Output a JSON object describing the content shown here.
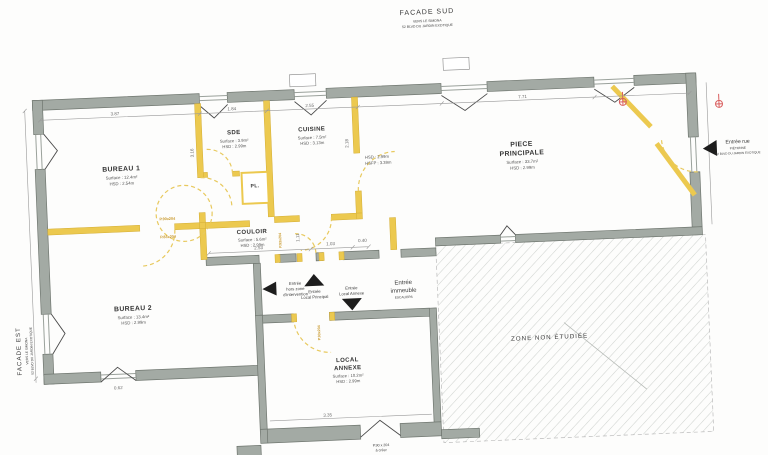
{
  "facade_sud": {
    "title": "FACADE SUD",
    "sub1": "VERS LE SIMONA",
    "sub2": "52 BLVD DU JARDIN EXOTIQUE"
  },
  "facade_est": {
    "title": "FACADE EST",
    "sub1": "VERS LE SIMONA",
    "sub2": "52 BLVD DU JARDIN EXOTIQUE"
  },
  "entree_rue": {
    "title": "Entrée rue",
    "sub1": "PIÉTONNE",
    "sub2": "52 BLVD DU JARDIN EXOTIQUE"
  },
  "rooms": [
    {
      "name": "BUREAU 1",
      "surface": "Surface : 12.4m²",
      "hsd": "HSD : 2.54m"
    },
    {
      "name": "SDE",
      "surface": "Surface : 3.9m²",
      "hsd": "HSD : 2.99m"
    },
    {
      "name": "CUISINE",
      "surface": "Surface : 7.5m²",
      "hsd": "HSD : 3.13m"
    },
    {
      "name1": "PIECE",
      "name2": "PRINCIPALE",
      "surface": "Surface : 33.7m²",
      "hsd": "HSD : 2.99m"
    },
    {
      "name": "COULOIR",
      "surface": "Surface : 5.6m²",
      "hsd": "HSD : 2.99m"
    },
    {
      "name": "BUREAU 2",
      "surface": "Surface : 13.4m²",
      "hsd": "HSD : 2.99m"
    },
    {
      "name1": "LOCAL",
      "name2": "ANNEXE",
      "surface": "Surface : 10.2m²",
      "hsd": "HSD : 2.99m"
    }
  ],
  "closet_label": "PL.",
  "height_note": {
    "l1": "HSD : 2.99m",
    "l2": "HSFP : 3.39m"
  },
  "zone_label": "ZONE NON ÉTUDIÉE",
  "entries": {
    "hors_zone": {
      "l1": "Entrée",
      "l2": "hors zone",
      "l3": "d'intervention"
    },
    "principal": {
      "l1": "Entrée",
      "l2": "Local Principal"
    },
    "annexe": {
      "l1": "Entrée",
      "l2": "Local Annexe"
    },
    "immeuble": {
      "l1": "Entrée",
      "l2": "immeuble",
      "sub": "ESCALIERS"
    }
  },
  "door_labels": {
    "d1": "P.90x204",
    "d2": "P.83x204",
    "d3": "P.93x204",
    "d4": "P.93x204",
    "bottom1": "P.90 x 204",
    "bottom2": "à créer"
  },
  "dimensions": {
    "top1": "3.87",
    "top2": "1.84",
    "top3": "2.55",
    "top4": "7.71",
    "couloir1": "2.53",
    "couloir2": "1.03",
    "couloir3": "0.40",
    "annexe": "3.35",
    "left": "0.62",
    "v1": "3.16",
    "v2": "2.18",
    "v3": "1.11"
  },
  "colors": {
    "wall": "#a3aaa4",
    "accent_yellow": "#e9c64f",
    "red": "#d95f5f",
    "hatch": "#cfd3cf"
  }
}
